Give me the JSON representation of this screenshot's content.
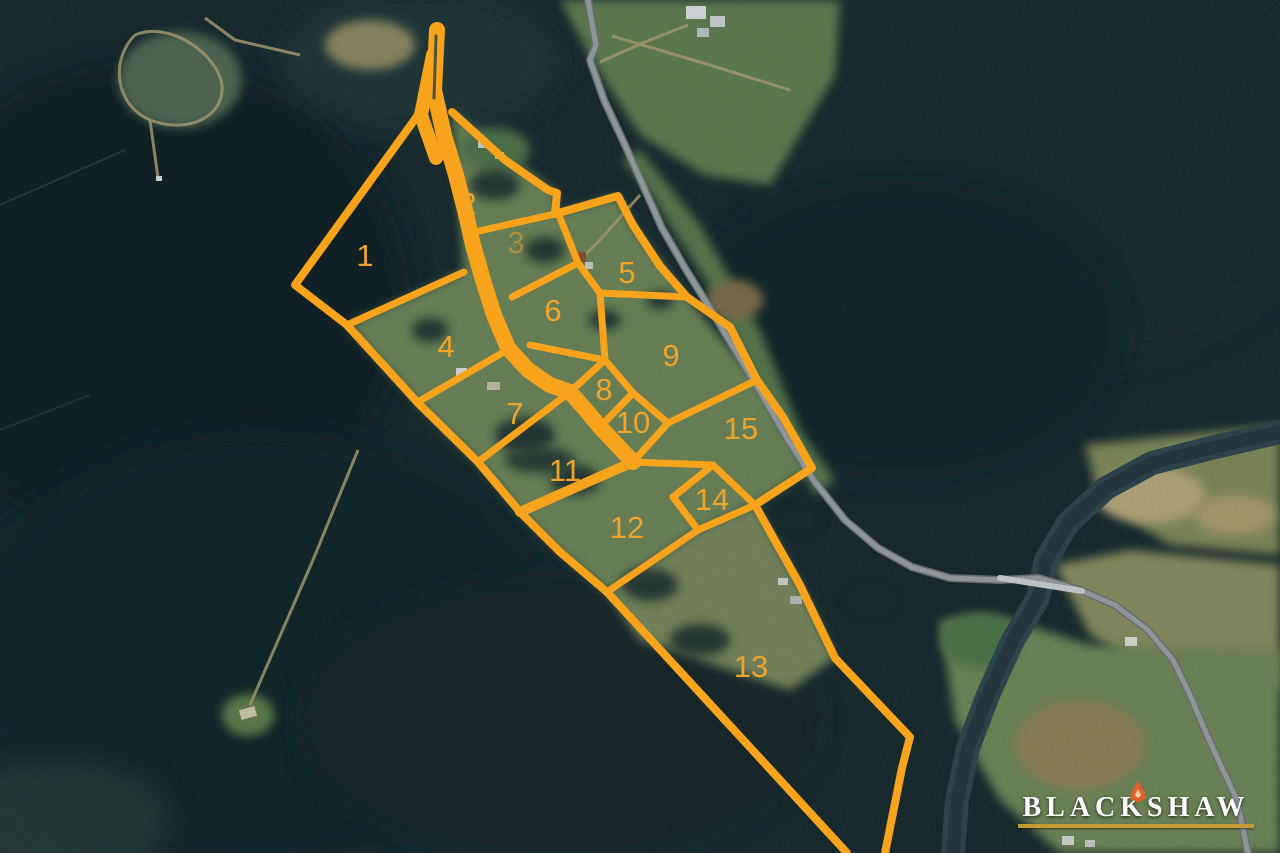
{
  "map": {
    "type": "aerial-subdivision-plan",
    "lot_count": 15,
    "overlay_color": "#F7A41C",
    "label_color": "#EFA42B",
    "label_font_size": 31,
    "lots": [
      {
        "id": "1",
        "x": 365,
        "y": 255,
        "opacity": 1
      },
      {
        "id": "2",
        "x": 468,
        "y": 203,
        "opacity": 1
      },
      {
        "id": "3",
        "x": 516,
        "y": 242,
        "opacity": 0.5
      },
      {
        "id": "4",
        "x": 446,
        "y": 346,
        "opacity": 1
      },
      {
        "id": "5",
        "x": 627,
        "y": 272,
        "opacity": 1
      },
      {
        "id": "6",
        "x": 553,
        "y": 310,
        "opacity": 1
      },
      {
        "id": "7",
        "x": 515,
        "y": 413,
        "opacity": 1
      },
      {
        "id": "8",
        "x": 604,
        "y": 389,
        "opacity": 1
      },
      {
        "id": "9",
        "x": 671,
        "y": 355,
        "opacity": 1
      },
      {
        "id": "10",
        "x": 633,
        "y": 422,
        "opacity": 1
      },
      {
        "id": "11",
        "x": 565,
        "y": 470,
        "opacity": 1
      },
      {
        "id": "12",
        "x": 627,
        "y": 527,
        "opacity": 1
      },
      {
        "id": "13",
        "x": 751,
        "y": 666,
        "opacity": 1
      },
      {
        "id": "14",
        "x": 712,
        "y": 499,
        "opacity": 1
      },
      {
        "id": "15",
        "x": 741,
        "y": 428,
        "opacity": 1
      }
    ],
    "road": {
      "name": "access-road",
      "points": "437,30 434,90 444,135 456,175 465,210 473,245 483,280 494,315 508,348 528,370 550,385 570,392 585,409 600,427 617,445 633,462",
      "width": 16
    },
    "road_funnel": {
      "points": "433,55 421,115 436,158",
      "width": 14
    },
    "road_gap": {
      "points": "436,36 434,98",
      "width": 3,
      "color": "#3a4a40"
    },
    "boundaries": [
      {
        "name": "outer-north-east",
        "width": 8,
        "points": "452,112 505,160 548,190 557,193 555,214 618,196 633,225 660,266 687,297 730,327 757,380 783,417 812,468 755,505 800,585 835,658 910,737 902,768 885,853"
      },
      {
        "name": "outer-west",
        "width": 8,
        "points": "418,115 295,285 347,325 418,403 478,462 520,512 560,552 607,592 700,693 780,780 847,853"
      },
      {
        "name": "lot1-lot4",
        "width": 7,
        "points": "347,325 464,272"
      },
      {
        "name": "lot2-south",
        "width": 7,
        "points": "470,233 555,214"
      },
      {
        "name": "lot3-lot5",
        "width": 7,
        "points": "557,210 578,263"
      },
      {
        "name": "lot3-lot6",
        "width": 7,
        "points": "512,297 578,263"
      },
      {
        "name": "lot5-lot6",
        "width": 7,
        "points": "578,263 600,293"
      },
      {
        "name": "lot5-lot9",
        "width": 7,
        "points": "600,293 687,297"
      },
      {
        "name": "lot6-lot9",
        "width": 7,
        "points": "600,293 605,360"
      },
      {
        "name": "lot6-lot8",
        "width": 7,
        "points": "530,345 605,360"
      },
      {
        "name": "lot8-nw",
        "width": 7,
        "points": "570,392 605,360"
      },
      {
        "name": "lot8-lot9",
        "width": 7,
        "points": "605,360 633,393"
      },
      {
        "name": "lot8-lot10",
        "width": 7,
        "points": "633,393 600,427"
      },
      {
        "name": "lot9-lot10",
        "width": 7,
        "points": "633,393 668,423"
      },
      {
        "name": "lot10-lot15",
        "width": 7,
        "points": "668,423 633,462"
      },
      {
        "name": "lot9-lot15",
        "width": 7,
        "points": "757,380 668,423"
      },
      {
        "name": "lot4-lot7",
        "width": 7,
        "points": "509,349 418,402"
      },
      {
        "name": "lot7-lot11",
        "width": 7,
        "points": "570,392 478,462"
      },
      {
        "name": "lot11-lot12",
        "width": 10,
        "points": "633,462 520,512"
      },
      {
        "name": "lot12-lot15",
        "width": 7,
        "points": "633,462 713,465"
      },
      {
        "name": "lot14-ne",
        "width": 7,
        "points": "713,465 755,505"
      },
      {
        "name": "lot14-se",
        "width": 7,
        "points": "755,505 698,530"
      },
      {
        "name": "lot14-sw",
        "width": 7,
        "points": "698,530 673,497"
      },
      {
        "name": "lot14-nw",
        "width": 7,
        "points": "673,497 713,465"
      },
      {
        "name": "lot12-lot13",
        "width": 7,
        "points": "607,592 698,530"
      }
    ],
    "features": {
      "highway": {
        "color": "#969b9e",
        "casing": "#6a7073",
        "width": 6,
        "points": "588,0 596,45 590,60 604,100 625,145 645,190 662,228 685,268 708,305 735,350 762,395 788,440 815,482 845,520 878,548 912,567 950,578 1000,580 1038,578 1080,590 1115,605 1148,630 1173,660 1190,695 1207,735 1222,768 1237,800 1248,853"
      },
      "bridge": {
        "color": "#c9cdce",
        "width": 6,
        "points": "1000,578 1082,591"
      },
      "river": {
        "color": "#2c4149",
        "core": "#22343c",
        "width": 24,
        "points": "1280,432 1215,447 1152,463 1106,488 1068,523 1046,560 1038,598 1012,642 988,695 968,748 957,800 953,853"
      }
    }
  },
  "branding": {
    "name": "BLACKSHAW",
    "text_color": "#FFFFFF",
    "underline_color": "#C49B35",
    "emblem_color": "#E0622A"
  }
}
